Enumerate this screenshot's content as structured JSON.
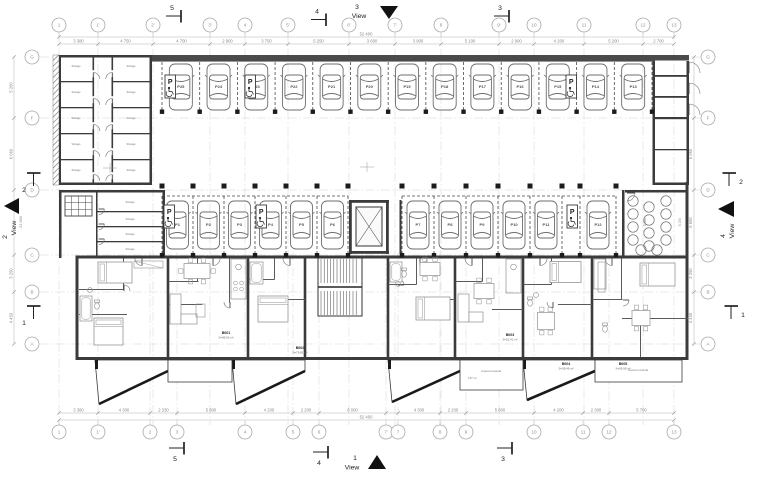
{
  "drawing_type": "architectural floor plan - ground floor with parking and apartments",
  "colors": {
    "wall": "#3b3b3b",
    "wall_dark": "#4a4a4a",
    "dim_line": "#b5b5b5",
    "dim_text": "#8a8a8a",
    "bubble": "#aaaaaa",
    "grid": "#cccccc",
    "car": "#6e6e6e",
    "furn": "#8f8f8f",
    "black": "#111111"
  },
  "grid": {
    "top": [
      "1",
      "1'",
      "2'",
      "3'",
      "4",
      "5'",
      "6'",
      "7'",
      "8",
      "9'",
      "10",
      "11",
      "12",
      "13"
    ],
    "bottom": [
      "1",
      "1'",
      "2",
      "3",
      "4",
      "5",
      "6",
      "7'",
      "7",
      "8",
      "9",
      "10",
      "11",
      "12",
      "13"
    ],
    "left": [
      "G",
      "F",
      "D",
      "C",
      "B",
      "A"
    ],
    "right": [
      "G",
      "F",
      "D",
      "C",
      "B",
      "A"
    ]
  },
  "dims": {
    "top": [
      "3 380",
      "4 750",
      "4 700",
      "2 900",
      "3 750",
      "5 250",
      "3 600",
      "3 900",
      "5 100",
      "2 900",
      "4 200",
      "5 200",
      "2 700"
    ],
    "top_total": "52 400",
    "bottom": [
      "3 380",
      "4 300",
      "2 330",
      "5 800",
      "4 200",
      "2 200",
      "6 000",
      "4 300",
      "2 200",
      "5 800",
      "4 200",
      "2 300",
      "5 700"
    ],
    "bottom_total": "52 400",
    "left": [
      "5 260",
      "6 060",
      "",
      "3 250",
      "4 450"
    ],
    "left_total": "24 660",
    "right": [
      "",
      "6 060",
      "5 650",
      "3 250",
      "4 450"
    ],
    "inner": [
      "5 380",
      "5 190"
    ]
  },
  "parking": {
    "top_row": [
      "P25",
      "P24",
      "P23",
      "P22",
      "P21",
      "P20",
      "P19",
      "P18",
      "P17",
      "P16",
      "P15",
      "P14",
      "P13"
    ],
    "middle_left": [
      "P1",
      "P2",
      "P3",
      "P4",
      "P5",
      "P6"
    ],
    "middle_right": [
      "P7",
      "P8",
      "P9",
      "P10",
      "P11",
      "P12"
    ],
    "sign_letter": "P"
  },
  "rooms": {
    "storage_label": "Storage"
  },
  "apartments": {
    "units": [
      {
        "id": "B001",
        "area": "S=85.60 m²"
      },
      {
        "id": "B002",
        "area": "S=79.81 m²"
      },
      {
        "id": "B003",
        "area": "S=52.41 m²"
      },
      {
        "id": "B004",
        "area": "S=58.46 m²"
      },
      {
        "id": "B005",
        "area": "S=58.08 m²"
      }
    ],
    "veranda_label": "covered veranda",
    "veranda_area": "7.67 m²"
  },
  "views": [
    {
      "num": "3",
      "label": "View"
    },
    {
      "num": "1",
      "label": "View"
    },
    {
      "num": "2",
      "label": "View"
    },
    {
      "num": "4",
      "label": "View"
    }
  ],
  "sections": {
    "top": [
      "5",
      "4",
      "3"
    ],
    "bottom": [
      "5",
      "4",
      "3"
    ],
    "left": [
      "2",
      "1"
    ],
    "right": [
      "2",
      "1"
    ]
  }
}
